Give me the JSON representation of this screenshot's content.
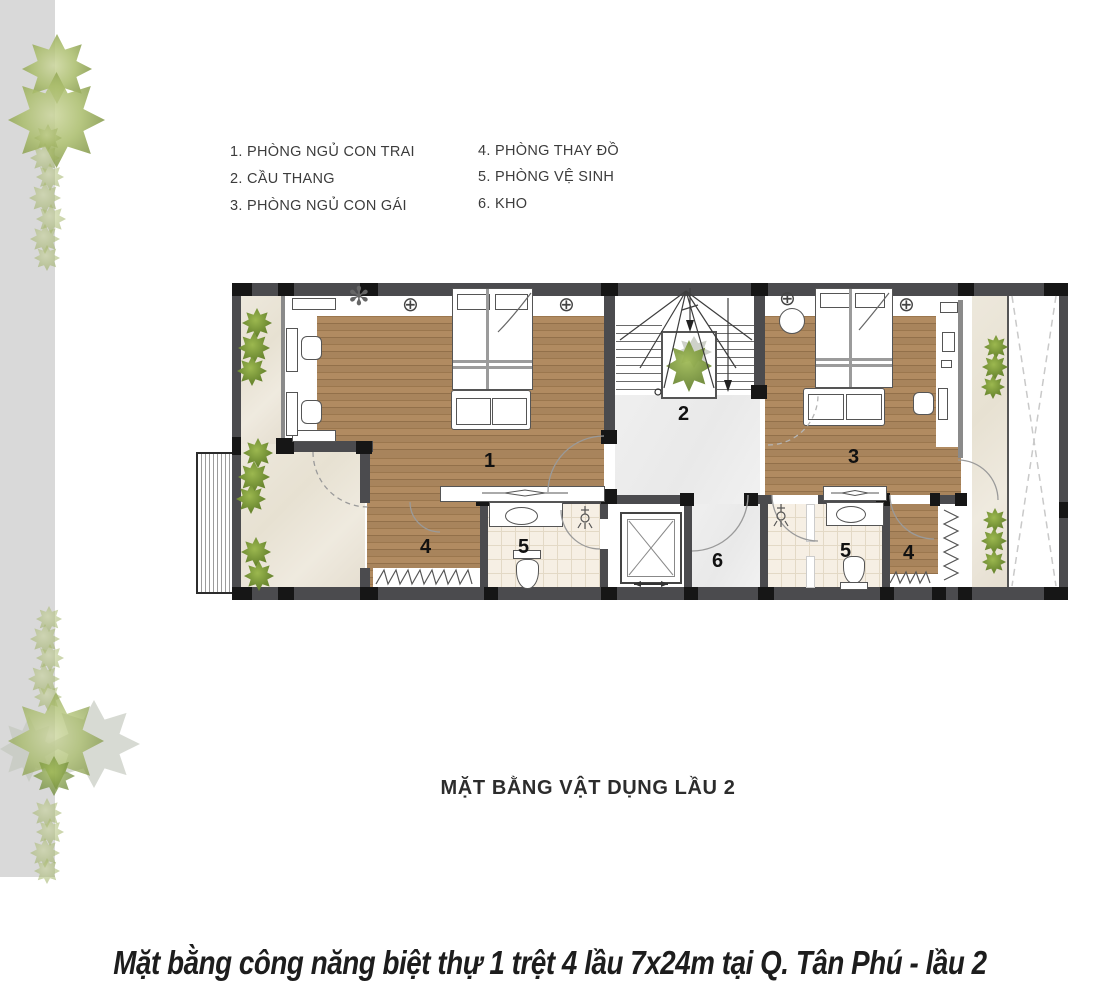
{
  "legend": {
    "columns": [
      {
        "items": [
          "1. PHÒNG NGỦ CON TRAI",
          "2. CẦU THANG",
          "3. PHÒNG NGỦ CON GÁI"
        ]
      },
      {
        "items": [
          "4. PHÒNG THAY ĐỒ",
          "5. PHÒNG VỆ SINH",
          "6. KHO"
        ]
      }
    ]
  },
  "plan": {
    "title": "MẶT BẰNG VẬT DỤNG LẦU 2",
    "room_labels": {
      "bedroom_boy": "1",
      "stairs": "2",
      "bedroom_girl": "3",
      "dressing_left": "4",
      "bathroom_left": "5",
      "storage": "6",
      "bathroom_right": "5",
      "dressing_right": "4"
    }
  },
  "caption": "Mặt bằng công  năng biệt thự 1 trệt 4 lầu 7x24m tại Q. Tân Phú - lầu 2",
  "icons": {
    "ceiling_light": "⊕",
    "ceiling_fan": "✻"
  },
  "colors": {
    "wood": "#a8845c",
    "wall": "#4b4b4e",
    "column": "#161616",
    "marble": "#ece7db",
    "tile": "#f6efe4",
    "hall_floor": "#ededed",
    "plant_green": "#6f8c33",
    "pale_green": "#9db05e",
    "side_strip": "#d9d9d9"
  }
}
